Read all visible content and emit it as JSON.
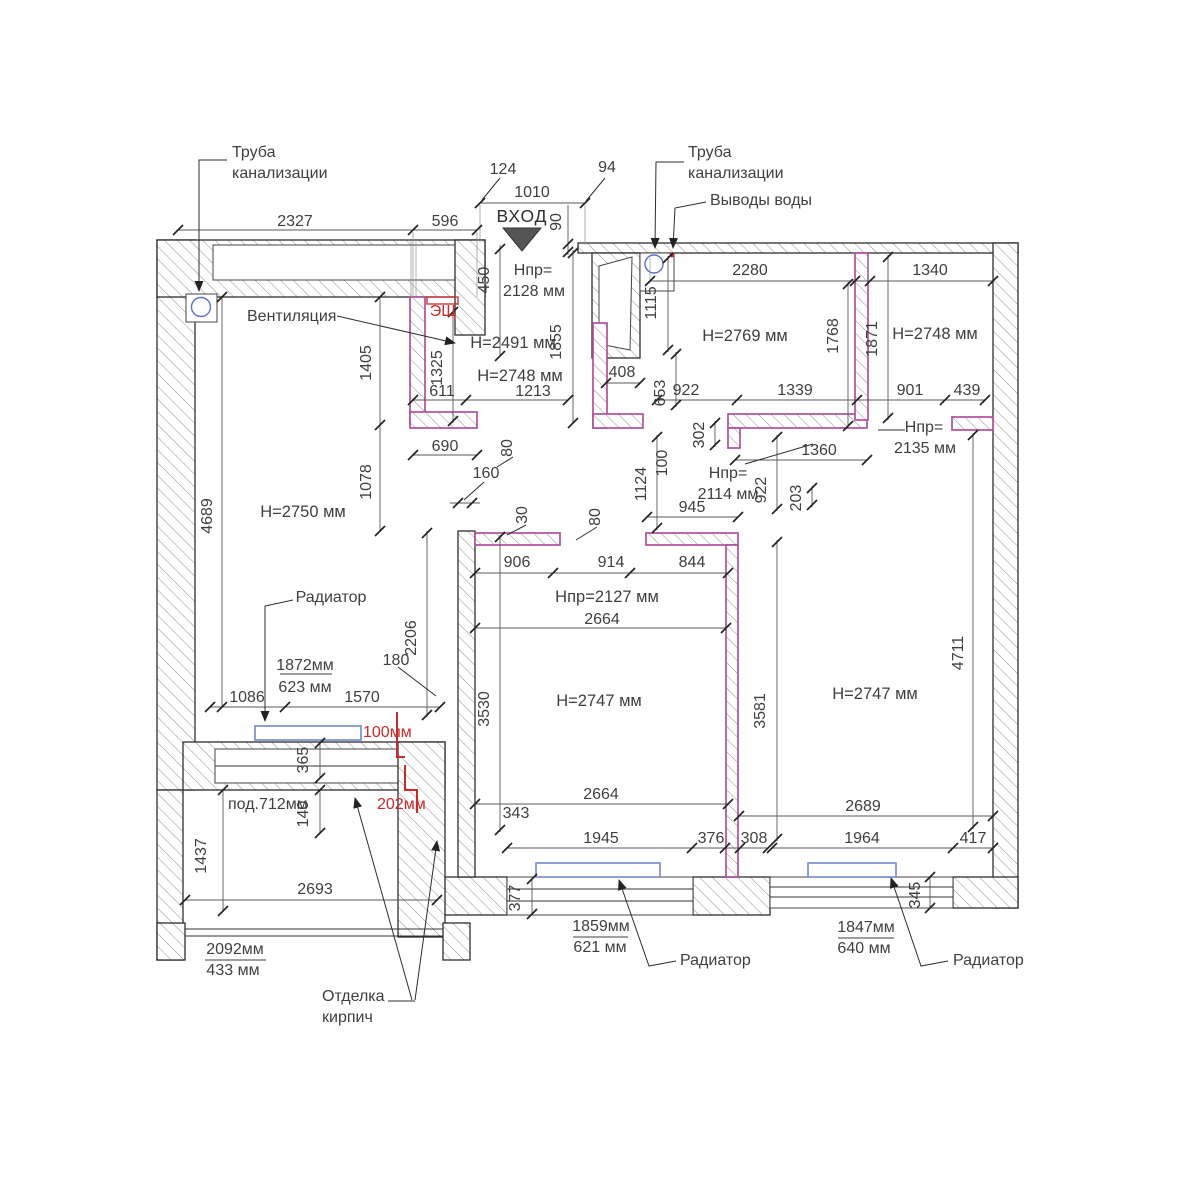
{
  "title": "Обмерный план квартиры",
  "colors": {
    "partition_outline": "#b0509a",
    "wall_hatch": "#9a9a9a",
    "radiator": "#7b8fd4",
    "pipe": "#5b6fd0",
    "red_mark": "#c92a2a",
    "dim_text": "#3f3f3f"
  },
  "labels": {
    "entrance": "ВХОД",
    "sewer_left_l1": "Труба",
    "sewer_left_l2": "канализации",
    "sewer_right_l1": "Труба",
    "sewer_right_l2": "канализации",
    "water_outlets": "Выводы воды",
    "ventilation": "Вентиляция",
    "electrical_panel": "ЭЩ",
    "radiator": "Радиатор",
    "brick_finish_l1": "Отделка",
    "brick_finish_l2": "кирпич",
    "window_sill": "под.712мм",
    "red_step_top": "100мм",
    "red_step_bottom": "202мм"
  },
  "room_heights": {
    "left_room": "H=2750 мм",
    "entry_hall_upper": "H=2491 мм",
    "entry_hall": "H=2748 мм",
    "kitchen": "H=2769 мм",
    "top_right_room": "H=2748 мм",
    "center_room": "H=2747 мм",
    "right_room": "H=2747 мм"
  },
  "opening_heights": {
    "entry_label": "Hпр=",
    "entry_value": "2128 мм",
    "hall_label": "Hпр=",
    "hall_value": "2114 мм",
    "right_label": "Hпр=",
    "right_value": "2135 мм",
    "center_door": "Hпр=2127 мм"
  },
  "radiator_specs": {
    "left_length": "1872мм",
    "left_height": "623 мм",
    "center_length": "1859мм",
    "center_height": "621 мм",
    "right_length": "1847мм",
    "right_height": "640 мм",
    "loggia_length": "2092мм",
    "loggia_height": "433 мм"
  },
  "dims": {
    "d124": "124",
    "d1010": "1010",
    "d94": "94",
    "d90": "90",
    "d2327": "2327",
    "d596": "596",
    "d2280": "2280",
    "d1340": "1340",
    "d450": "450",
    "d1115": "1115",
    "d1855": "1855",
    "d1768": "1768",
    "d1871": "1871",
    "d1405": "1405",
    "d1325": "1325",
    "d408": "408",
    "d611": "611",
    "d1213": "1213",
    "d653": "653",
    "d922a": "922",
    "d1339": "1339",
    "d901": "901",
    "d439": "439",
    "d302": "302",
    "d1360": "1360",
    "d100": "100",
    "d690": "690",
    "d80a": "80",
    "d160": "160",
    "d1124": "1124",
    "d922b": "922",
    "d203": "203",
    "d945": "945",
    "d4689": "4689",
    "d1078": "1078",
    "d30": "30",
    "d80b": "80",
    "d906": "906",
    "d914": "914",
    "d844": "844",
    "d2664a": "2664",
    "d2206": "2206",
    "d180": "180",
    "d3530": "3530",
    "d3581": "3581",
    "d4711": "4711",
    "d1086": "1086",
    "d1570": "1570",
    "d365": "365",
    "d140": "140",
    "d1437": "1437",
    "d2693": "2693",
    "d343": "343",
    "d2664b": "2664",
    "d1945": "1945",
    "d376": "376",
    "d308": "308",
    "d377": "377",
    "d2689": "2689",
    "d1964": "1964",
    "d417": "417",
    "d345": "345"
  }
}
